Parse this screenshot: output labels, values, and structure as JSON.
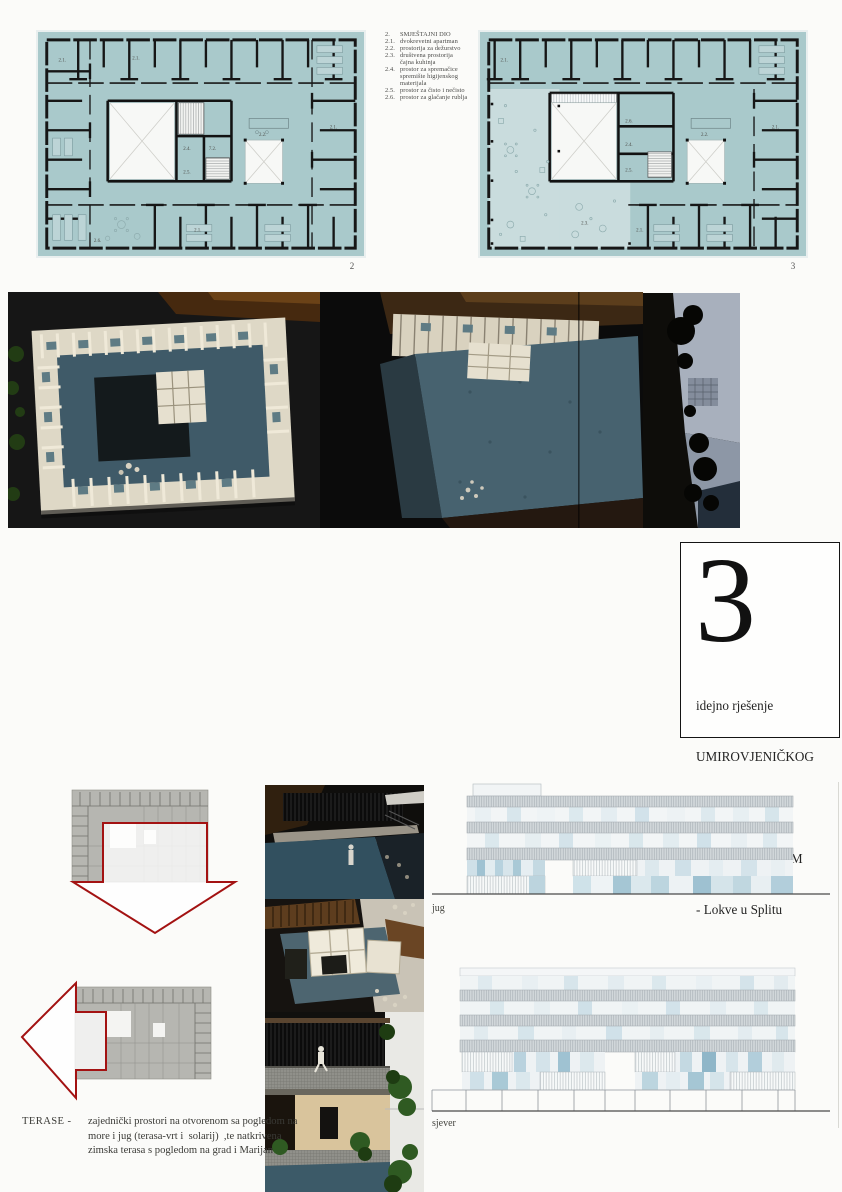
{
  "colors": {
    "teal": "#a9c9cb",
    "teal_light": "#c9dcdd",
    "accent_red": "#a31212",
    "plan_grey": "#b6b6b1"
  },
  "legend": {
    "items": [
      {
        "num": "2.",
        "text": "SMJEŠTAJNI DIO"
      },
      {
        "num": "2.1.",
        "text": "dvokrevetni apartman"
      },
      {
        "num": "2.2.",
        "text": "prostorija za dežurstvo"
      },
      {
        "num": "2.3.",
        "text": "društvena prostorija"
      },
      {
        "num": "",
        "text": "čajna kuhinja"
      },
      {
        "num": "2.4.",
        "text": "prostor za spremačice"
      },
      {
        "num": "",
        "text": "spremište higijenskog materijala"
      },
      {
        "num": "2.5.",
        "text": "prostor za čisto i nečisto"
      },
      {
        "num": "2.6.",
        "text": "prostor za glačanje rublja"
      }
    ]
  },
  "plans": {
    "plan2_number": "2",
    "plan3_number": "3",
    "room_labels": [
      "2.1.",
      "2.2.",
      "2.3.",
      "2.4.",
      "2.5.",
      "2.6.",
      "7.2."
    ]
  },
  "title_block": {
    "number": "3",
    "line1": "idejno rješenje",
    "line2": "UMIROVJENIČKOG",
    "line3": " DOMA",
    "line4": "S POLIKLINIKOM",
    "line5": "- Lokve u Splitu"
  },
  "elevations": {
    "south_label": "jug",
    "north_label": "sjever"
  },
  "terase": {
    "label": "TERASE  -",
    "line1": "zajednički prostori na otvorenom sa pogledom na",
    "line2": "more i jug (terasa-vrt i  solarij)  ,te natkrivena",
    "line3": "zimska terasa s pogledom na grad i Marijan"
  }
}
